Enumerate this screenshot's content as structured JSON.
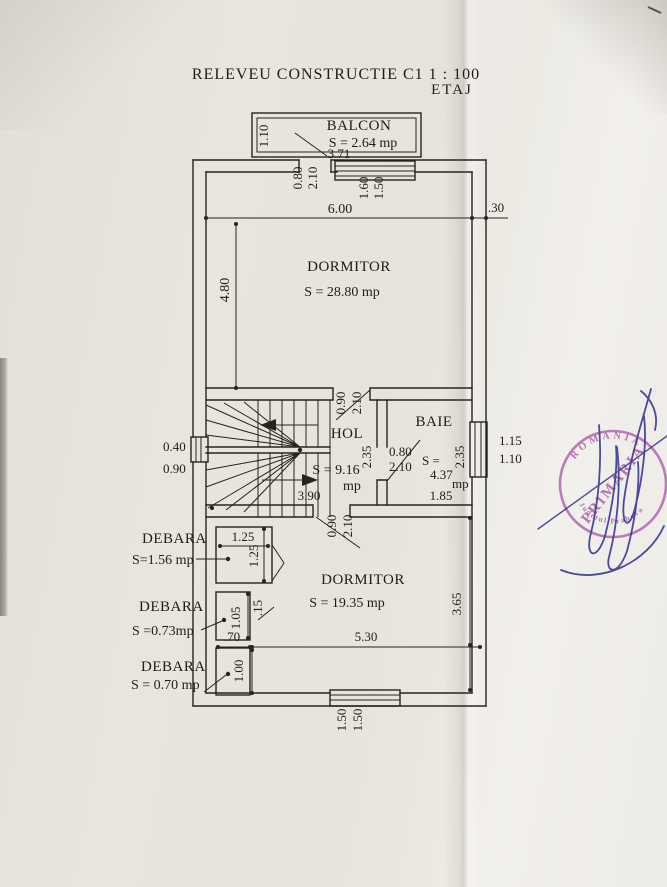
{
  "title": {
    "main": "RELEVEU CONSTRUCTIE C1  1 : 100",
    "sub": "ETAJ"
  },
  "rooms": {
    "balcon": {
      "name": "BALCON",
      "area": "S = 2.64 mp",
      "width": "3.71",
      "depth": "1.10"
    },
    "dormitor_mare": {
      "name": "DORMITOR",
      "area": "S = 28.80 mp"
    },
    "hol": {
      "name": "HOL",
      "area": "S = 9.16",
      "unit": "mp",
      "width": "3.90",
      "depth": "2.35"
    },
    "baie": {
      "name": "BAIE",
      "area_prefix": "S =",
      "area_value": "4.37",
      "unit": "mp",
      "width": "1.85",
      "depth": "2.35"
    },
    "dormitor_mic": {
      "name": "DORMITOR",
      "area": "S = 19.35 mp",
      "width": "5.30",
      "depth": "3.65"
    },
    "debara1": {
      "name": "DEBARA",
      "area": "S=1.56 mp",
      "width": "1.25",
      "depth": "1.25"
    },
    "debara2": {
      "name": "DEBARA",
      "area": "S =0.73mp",
      "width": ".70",
      "depth": "1.05",
      "wall_gap": ".15"
    },
    "debara3": {
      "name": "DEBARA",
      "area": "S = 0.70 mp",
      "depth": "1.00"
    }
  },
  "dims": {
    "overall_width": "6.00",
    "wall_thickness": ".30",
    "room_depth": "4.80",
    "balcony_door_w": "0.80",
    "balcony_door_h": "2.10",
    "window_top_w": "1.60",
    "window_top_h": "1.50",
    "hol_door_top_w": "0.90",
    "hol_door_top_h": "2.10",
    "hol_door_bottom_w": "0.90",
    "hol_door_bottom_h": "2.10",
    "baie_door_w": "0.80",
    "baie_door_h": "2.10",
    "window_left_w": "0.40",
    "window_left_h": "0.90",
    "window_right_w": "1.15",
    "window_right_h": "1.10",
    "window_bottom_w": "1.50",
    "window_bottom_h": "1.50"
  },
  "stamp": {
    "arc_top": "ROMANIA",
    "center": "PRIMARIA",
    "arc_bottom": "Judetul Prahova"
  },
  "colors": {
    "ink": "#27241f",
    "stamp": "#a85fa8",
    "signature": "#3d3d95",
    "paper": "#e8e5de"
  }
}
